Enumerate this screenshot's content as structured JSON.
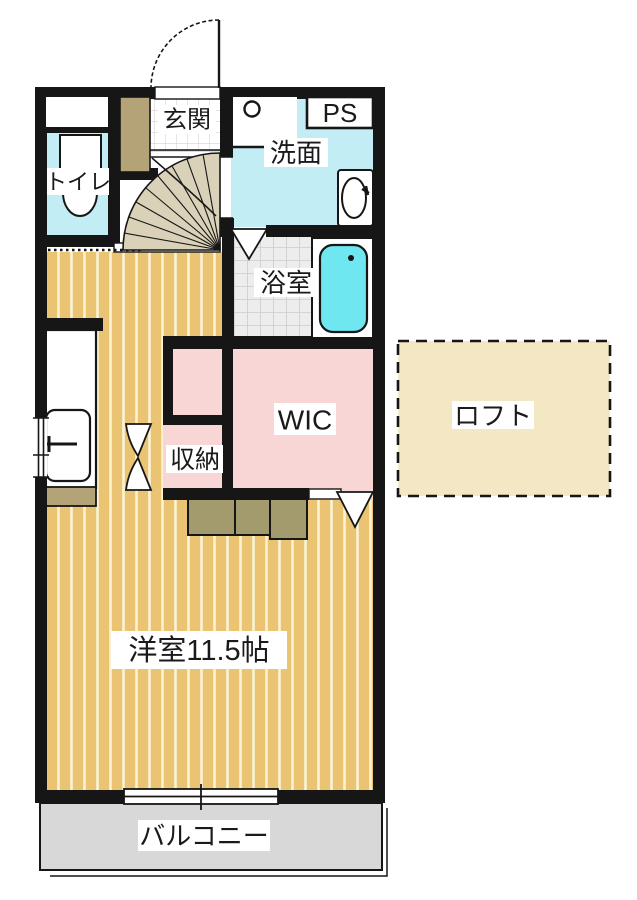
{
  "floorplan": {
    "title": "apartment-floorplan",
    "rooms": {
      "genkan": {
        "label": "玄関"
      },
      "ps": {
        "label": "PS"
      },
      "senmen": {
        "label": "洗面"
      },
      "toilet": {
        "label": "トイレ"
      },
      "bathroom": {
        "label": "浴室"
      },
      "wic": {
        "label": "WIC"
      },
      "storage": {
        "label": "収納"
      },
      "loft": {
        "label": "ロフト"
      },
      "main_room": {
        "label": "洋室11.5帖"
      },
      "balcony": {
        "label": "バルコニー"
      }
    },
    "colors": {
      "wall": "#161616",
      "cyan_room": "#c3edf5",
      "tub": "#6fe7f0",
      "pink": "#f8d6d6",
      "floor_tan": "#ebc473",
      "floor_stripe": "#fcf3d3",
      "loft_fill": "#f3e8c3",
      "khaki": "#b3a376",
      "step": "#a39b6d",
      "balcony_gray": "#d8d8d8",
      "tile_bg": "#ededed",
      "tile_line": "#cbcbcb",
      "genkan_tile_line": "#d4d4d4",
      "fan": "#d9d1b8",
      "white": "#ffffff"
    }
  }
}
